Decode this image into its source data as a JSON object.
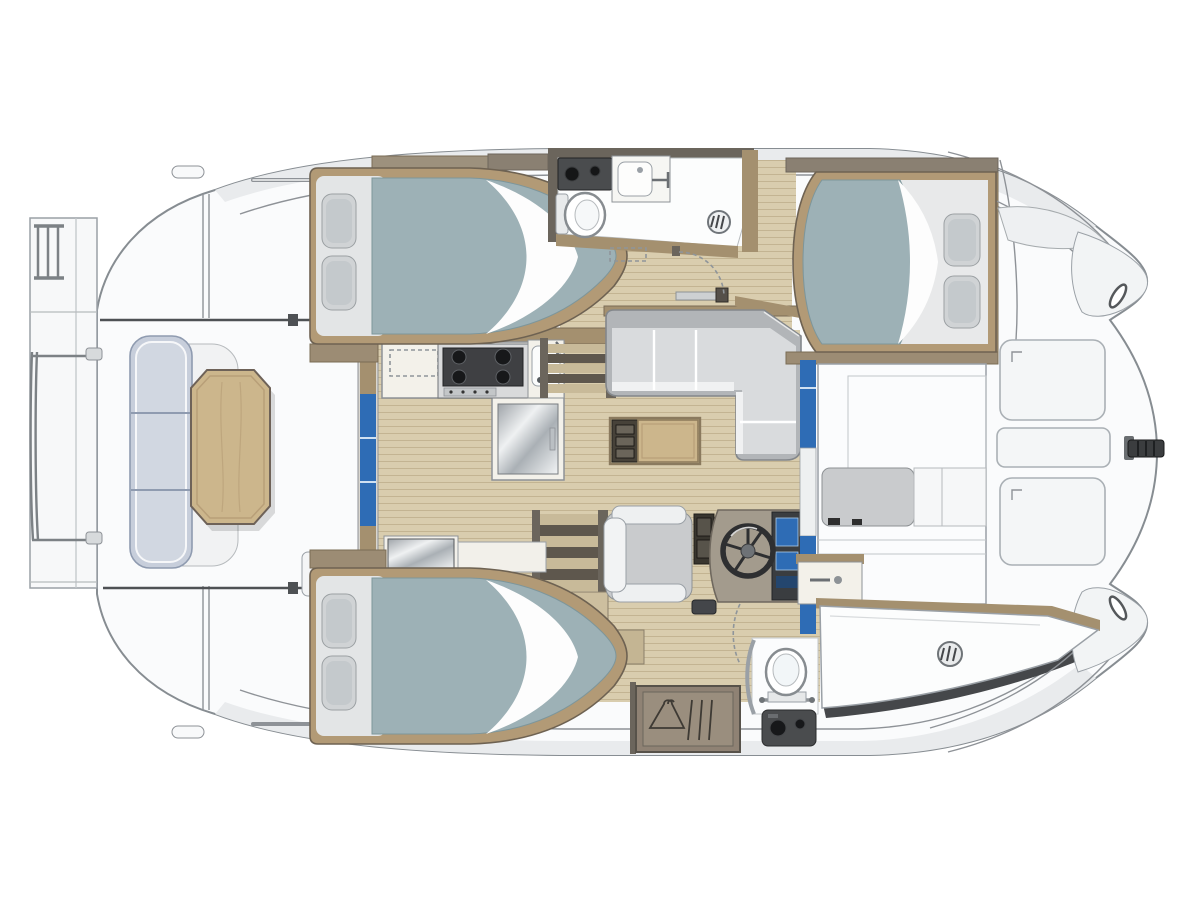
{
  "meta": {
    "title": "Power catamaran interior deck plan, overhead view",
    "view": "top-down floor plan",
    "orientation": {
      "bow": "right",
      "stern": "left"
    }
  },
  "palette": {
    "hull": "#fafbfc",
    "hullStroke": "#878d92",
    "deckBand": "#e9ebed",
    "deckLine": "#7c8185",
    "floorWood": "#d9cdae",
    "floorLine": "#c3b492",
    "wallWood": "#a4906f",
    "wallDark": "#6b655c",
    "frameWood": "#b29a76",
    "frameStroke": "#6e6252",
    "duvet": "#9db1b6",
    "duvetStroke": "#7d969b",
    "pillow": "#d0d3d5",
    "pillowStroke": "#9ba0a3",
    "sofaSeat": "#d9dbdd",
    "sofaBack": "#b2b5b8",
    "sofaStroke": "#83878b",
    "tableWood": "#ccb68c",
    "tableStroke": "#6e6258",
    "benchCushion": "#c7cedb",
    "benchStroke": "#8f9bb0",
    "counter": "#f3f1ea",
    "stoveDark": "#3f4043",
    "applianceDark": "#4a4c4e",
    "accentBlue": "#2e6cb5",
    "charcoal": "#45474a",
    "showerWhite": "#fcfdfd",
    "seatGray": "#c9cbcd",
    "stepLight": "#c8ba99",
    "stepDark": "#5e574d"
  },
  "layout": {
    "rooms": [
      {
        "id": "stern-platform",
        "name": "Stern platform with boarding ladder and rails"
      },
      {
        "id": "cockpit",
        "name": "Aft cockpit with curved bench and table"
      },
      {
        "id": "galley",
        "name": "Galley with cooktop, sink and refrigerator"
      },
      {
        "id": "salon",
        "name": "Salon with L-shaped sofa and coffee table"
      },
      {
        "id": "helm-station",
        "name": "Helm station with seat, wheel and console"
      },
      {
        "id": "port-aft-cabin",
        "name": "Port aft double cabin"
      },
      {
        "id": "port-head",
        "name": "Port head with toilet, basin and shower"
      },
      {
        "id": "forward-cabin",
        "name": "Forward double cabin"
      },
      {
        "id": "forward-berth-area",
        "name": "Starboard forward berth and cabinetry"
      },
      {
        "id": "starboard-aft-cabin",
        "name": "Starboard aft double cabin"
      },
      {
        "id": "starboard-head",
        "name": "Starboard head with toilet, basin and shower"
      },
      {
        "id": "wardrobe",
        "name": "Hanging locker"
      },
      {
        "id": "foredeck",
        "name": "Foredeck with deck hatches"
      }
    ],
    "furniture": [
      "double bed",
      "pillows",
      "L-shaped sofa",
      "coffee table",
      "cockpit bench",
      "cockpit table",
      "helm seat",
      "steering wheel",
      "instrument console",
      "cooktop",
      "galley sink",
      "refrigerator",
      "vanity mirror",
      "toilet",
      "washbasin",
      "shower drain",
      "washer unit",
      "hanging locker",
      "companionway stairs",
      "deck hatch",
      "bow cleat",
      "fairlead",
      "grab rail",
      "roof hatch",
      "boarding ladder",
      "sliding door"
    ],
    "counts": {
      "cabins": 3,
      "heads": 2,
      "stairways": 2,
      "deck_hatches": 3
    }
  }
}
